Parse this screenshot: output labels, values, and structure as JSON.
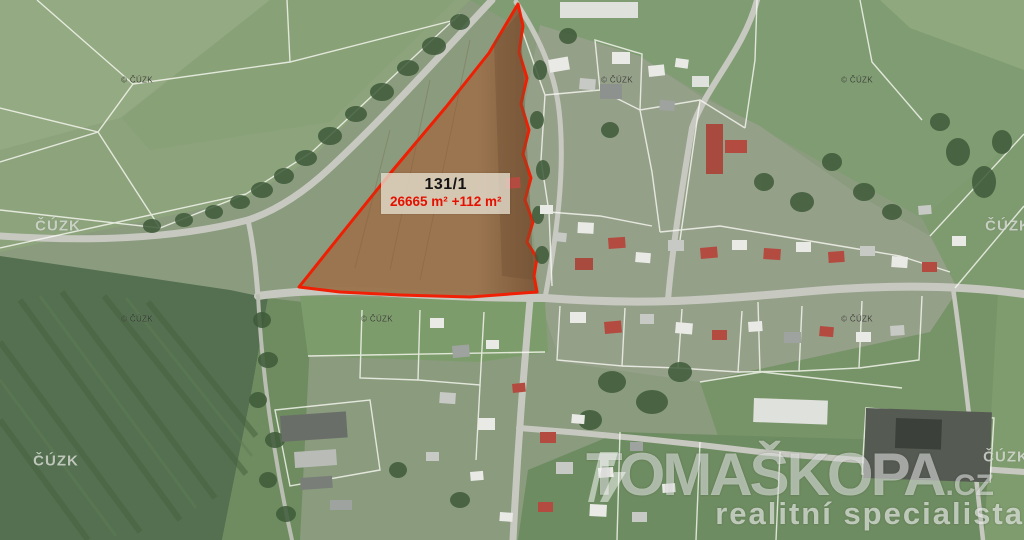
{
  "map": {
    "parcel": {
      "id": "131/1",
      "area": "26665 m²",
      "area_delta": "+112 m²"
    },
    "watermarks": {
      "copyright_small": "© ČÚZK",
      "copyright_large": "ČÚZK",
      "brand_name": "TOMAŠKOPA",
      "brand_tld": ".CZ",
      "brand_tagline": "realitní specialista"
    }
  },
  "colors": {
    "parcel_outline": "#f21b00",
    "parcel_fill": "#9c744f",
    "parcel_fill_dark": "#7c5839",
    "parcel_area_text": "#e51000",
    "road": "#c7c9c1",
    "cadastral_line": "#fcfcf6",
    "field_light": "#8ca37c",
    "field_dark": "#547050",
    "brand_text": "rgba(255,255,255,0.5)"
  }
}
